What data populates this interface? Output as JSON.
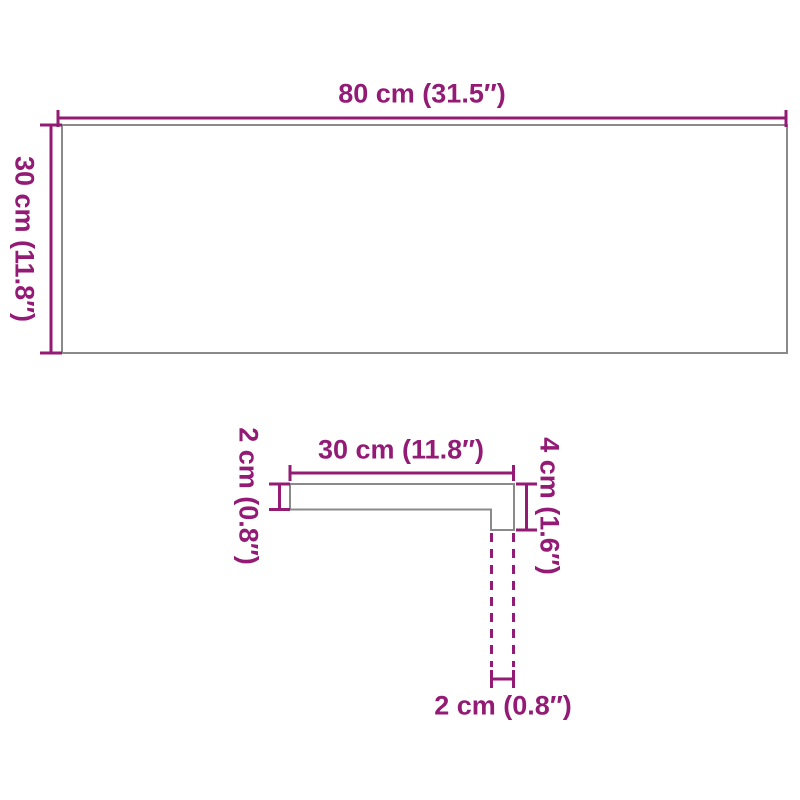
{
  "diagram_title": "board-dimension-diagram",
  "colors": {
    "dimension": "#931b76",
    "outline": "#8a8a8a",
    "background": "#ffffff"
  },
  "top_view": {
    "shape": "rectangle",
    "width_label": "80 cm (31.5″)",
    "height_label": "30 cm (11.8″)"
  },
  "profile_view": {
    "shape": "L-profile cross-section",
    "top_width_label": "30 cm (11.8″)",
    "thickness_label": "2 cm (0.8″)",
    "nose_height_label": "4 cm (1.6″)",
    "nose_width_label": "2 cm (0.8″)"
  }
}
